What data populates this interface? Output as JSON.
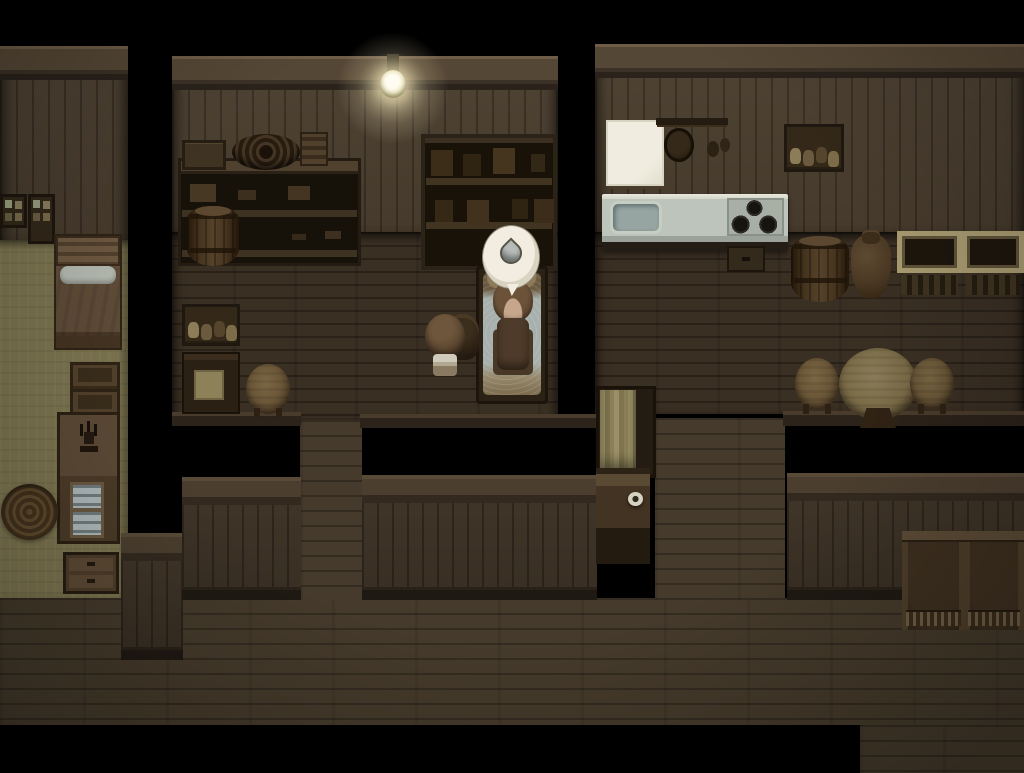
{
  "scene": {
    "description": "rpg-house-interior-night",
    "canvas": {
      "width": 1024,
      "height": 773
    },
    "background": "#000000",
    "palette": {
      "wall_plank": "#483c2e",
      "wall_beam": "#554735",
      "room_floor": "#3a2f23",
      "hall_floor": "#453a2b",
      "bedroom_floor": "#7d7550",
      "counter_top": "#bdc4bc",
      "lamp_glow": "#fff3c4",
      "bubble_fill": "#f2ede0",
      "droplet": "#979f9e"
    },
    "regions": [
      {
        "name": "hallway-floor",
        "kind": "floor-hall",
        "x": 0,
        "y": 598,
        "w": 1024,
        "h": 127
      },
      {
        "name": "hallway-floor-extension",
        "kind": "floor-hall",
        "x": 860,
        "y": 725,
        "w": 164,
        "h": 48
      },
      {
        "name": "middle-doorway-floor",
        "kind": "floor-hall",
        "x": 300,
        "y": 420,
        "w": 62,
        "h": 180
      },
      {
        "name": "right-doorway-floor",
        "kind": "floor-hall",
        "x": 655,
        "y": 418,
        "w": 130,
        "h": 182
      },
      {
        "name": "left-room-wall",
        "kind": "wall-room",
        "x": 0,
        "y": 46,
        "w": 128,
        "h": 196
      },
      {
        "name": "left-room-floor",
        "kind": "floor-khaki",
        "x": 0,
        "y": 240,
        "w": 128,
        "h": 358
      },
      {
        "name": "middle-room-wall",
        "kind": "wall-room",
        "x": 172,
        "y": 56,
        "w": 386,
        "h": 178
      },
      {
        "name": "middle-room-floor",
        "kind": "floor-room",
        "x": 172,
        "y": 232,
        "w": 386,
        "h": 188
      },
      {
        "name": "right-room-wall",
        "kind": "wall-room",
        "x": 595,
        "y": 44,
        "w": 429,
        "h": 190
      },
      {
        "name": "right-room-floor",
        "kind": "floor-room",
        "x": 595,
        "y": 232,
        "w": 429,
        "h": 182
      },
      {
        "name": "middle-room-ledge-left",
        "kind": "ledge",
        "x": 172,
        "y": 412,
        "w": 129,
        "h": 14
      },
      {
        "name": "middle-room-ledge-right",
        "kind": "ledge",
        "x": 360,
        "y": 414,
        "w": 240,
        "h": 14
      },
      {
        "name": "right-room-ledge",
        "kind": "ledge",
        "x": 783,
        "y": 411,
        "w": 241,
        "h": 15
      },
      {
        "name": "front-wall-left",
        "kind": "front-wall",
        "x": 121,
        "y": 533,
        "w": 62,
        "h": 127
      },
      {
        "name": "front-wall-middle-left",
        "kind": "front-wall",
        "x": 182,
        "y": 477,
        "w": 119,
        "h": 123
      },
      {
        "name": "front-wall-middle-right",
        "kind": "front-wall",
        "x": 362,
        "y": 475,
        "w": 235,
        "h": 125
      },
      {
        "name": "front-wall-right",
        "kind": "front-wall",
        "x": 787,
        "y": 473,
        "w": 237,
        "h": 127
      }
    ],
    "furniture": [
      {
        "name": "hanging-lamp",
        "kind": "lamp",
        "x": 370,
        "y": 54,
        "w": 46,
        "h": 66
      },
      {
        "name": "storage-shelf",
        "kind": "shelf-unit",
        "x": 178,
        "y": 158,
        "w": 183,
        "h": 108
      },
      {
        "name": "crate-on-shelf",
        "kind": "crate-box",
        "x": 182,
        "y": 140,
        "w": 44,
        "h": 30
      },
      {
        "name": "rope-coil",
        "kind": "rope-coil",
        "x": 232,
        "y": 134,
        "w": 68,
        "h": 36
      },
      {
        "name": "box-on-shelf",
        "kind": "radio",
        "x": 300,
        "y": 132,
        "w": 28,
        "h": 34
      },
      {
        "name": "small-barrel",
        "kind": "barrel",
        "x": 187,
        "y": 206,
        "w": 52,
        "h": 60
      },
      {
        "name": "bookshelf",
        "kind": "bookshelf",
        "x": 421,
        "y": 134,
        "w": 136,
        "h": 136
      },
      {
        "name": "jar-shelf-left",
        "kind": "jar-shelf",
        "x": 182,
        "y": 304,
        "w": 58,
        "h": 42
      },
      {
        "name": "writing-desk",
        "kind": "desk",
        "x": 182,
        "y": 352,
        "w": 58,
        "h": 62
      },
      {
        "name": "round-stool-left",
        "kind": "stool-wood",
        "x": 246,
        "y": 364,
        "w": 44,
        "h": 50
      },
      {
        "name": "bed-with-blanket",
        "kind": "bed-sleep",
        "x": 476,
        "y": 266,
        "w": 72,
        "h": 138
      },
      {
        "name": "floor-basket",
        "kind": "basket",
        "x": 446,
        "y": 314,
        "w": 33,
        "h": 46
      },
      {
        "name": "wall-whiteboard",
        "kind": "whiteboard",
        "x": 606,
        "y": 120,
        "w": 58,
        "h": 66
      },
      {
        "name": "pot-rack",
        "kind": "pot-rack",
        "x": 656,
        "y": 112,
        "w": 72,
        "h": 62
      },
      {
        "name": "kitchen-counter",
        "kind": "counter",
        "x": 602,
        "y": 194,
        "w": 186,
        "h": 56
      },
      {
        "name": "under-counter-cabinet",
        "kind": "small-cabinet",
        "x": 727,
        "y": 246,
        "w": 38,
        "h": 26
      },
      {
        "name": "jar-shelf-right",
        "kind": "jar-shelf",
        "x": 784,
        "y": 124,
        "w": 60,
        "h": 48
      },
      {
        "name": "storage-barrel",
        "kind": "barrel",
        "x": 791,
        "y": 236,
        "w": 58,
        "h": 66
      },
      {
        "name": "clay-jug",
        "kind": "jug",
        "x": 851,
        "y": 234,
        "w": 40,
        "h": 64
      },
      {
        "name": "crate-left",
        "kind": "crate",
        "x": 897,
        "y": 231,
        "w": 65,
        "h": 66
      },
      {
        "name": "crate-right",
        "kind": "crate",
        "x": 962,
        "y": 231,
        "w": 62,
        "h": 66
      },
      {
        "name": "round-table",
        "kind": "table-round",
        "x": 839,
        "y": 348,
        "w": 78,
        "h": 72
      },
      {
        "name": "round-stool-a",
        "kind": "stool-round",
        "x": 795,
        "y": 358,
        "w": 44,
        "h": 52
      },
      {
        "name": "round-stool-b",
        "kind": "stool-round",
        "x": 910,
        "y": 358,
        "w": 44,
        "h": 52
      },
      {
        "name": "curtain-cabinet",
        "kind": "curtain-cabinet",
        "x": 596,
        "y": 386,
        "w": 60,
        "h": 92
      },
      {
        "name": "night-stand",
        "kind": "nightstand",
        "x": 596,
        "y": 468,
        "w": 54,
        "h": 96
      },
      {
        "name": "cloth-chair-left",
        "kind": "cloth-chair",
        "x": 902,
        "y": 531,
        "w": 63,
        "h": 99
      },
      {
        "name": "cloth-chair-right",
        "kind": "cloth-chair",
        "x": 964,
        "y": 531,
        "w": 60,
        "h": 99
      },
      {
        "name": "wall-box-shelf-a",
        "kind": "shelf-box",
        "x": 0,
        "y": 194,
        "w": 27,
        "h": 34
      },
      {
        "name": "wall-box-shelf-b",
        "kind": "shelf-box",
        "x": 28,
        "y": 194,
        "w": 27,
        "h": 50
      },
      {
        "name": "bedroom-bed",
        "kind": "bed-left",
        "x": 54,
        "y": 234,
        "w": 68,
        "h": 116
      },
      {
        "name": "bench-a",
        "kind": "bench",
        "x": 70,
        "y": 362,
        "w": 50,
        "h": 30
      },
      {
        "name": "bench-b",
        "kind": "bench",
        "x": 70,
        "y": 389,
        "w": 50,
        "h": 30
      },
      {
        "name": "display-cabinet",
        "kind": "cabinet-glass",
        "x": 57,
        "y": 412,
        "w": 63,
        "h": 132
      },
      {
        "name": "drawer-chest",
        "kind": "drawers",
        "x": 63,
        "y": 552,
        "w": 56,
        "h": 42
      },
      {
        "name": "round-rug",
        "kind": "rug",
        "x": 1,
        "y": 484,
        "w": 57,
        "h": 56
      }
    ],
    "entities": [
      {
        "name": "child-character",
        "kind": "char-child",
        "x": 423,
        "y": 306,
        "w": 45,
        "h": 72,
        "click": true
      },
      {
        "name": "sleeping-character",
        "kind": "char-sleep",
        "x": 489,
        "y": 280,
        "w": 48,
        "h": 100,
        "click": true
      },
      {
        "name": "sweat-drop-emote-bubble",
        "kind": "bubble",
        "x": 483,
        "y": 226,
        "w": 56,
        "h": 62,
        "click": false
      }
    ],
    "icons": [
      {
        "name": "sweat-drop-icon",
        "meaning": "water droplet emote above sleeping character",
        "symbol": "droplet"
      }
    ]
  }
}
